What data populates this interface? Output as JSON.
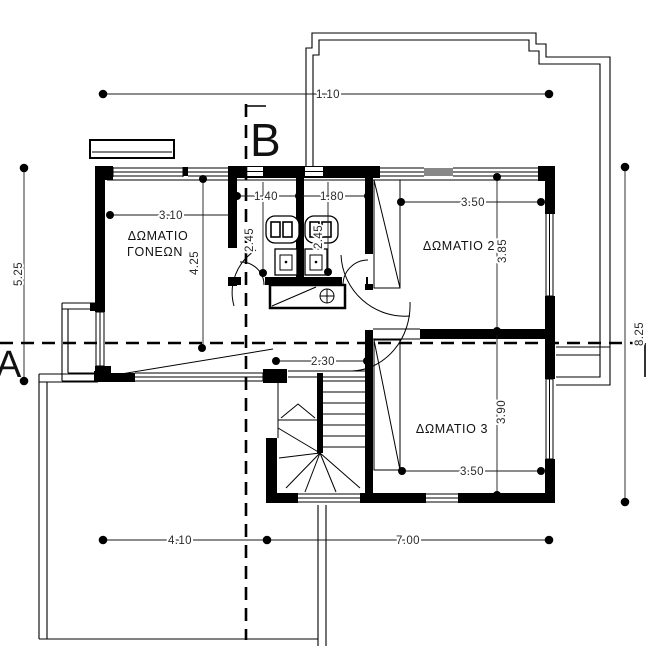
{
  "sections": {
    "a": "A",
    "b": "B"
  },
  "rooms": {
    "parents_line1": "ΔΩΜΑΤΙΟ",
    "parents_line2": "ΓΟΝΕΩΝ",
    "room2": "ΔΩΜΑΤΙΟ 2",
    "room3": "ΔΩΜΑΤΙΟ 3"
  },
  "dims": {
    "top": "1.10",
    "left": "5.25",
    "right": "8.25",
    "bottom_left": "4.10",
    "bottom_right": "7.00",
    "parents_w": "3.10",
    "parents_h": "4.25",
    "bath1_w": "1.40",
    "bath2_w": "1.80",
    "bath1_d": "2.45",
    "bath2_d": "2.45",
    "room2_w": "3.50",
    "room2_d": "3.85",
    "room3_w": "3.50",
    "room3_d": "3.90",
    "hall_w": "2.30"
  }
}
